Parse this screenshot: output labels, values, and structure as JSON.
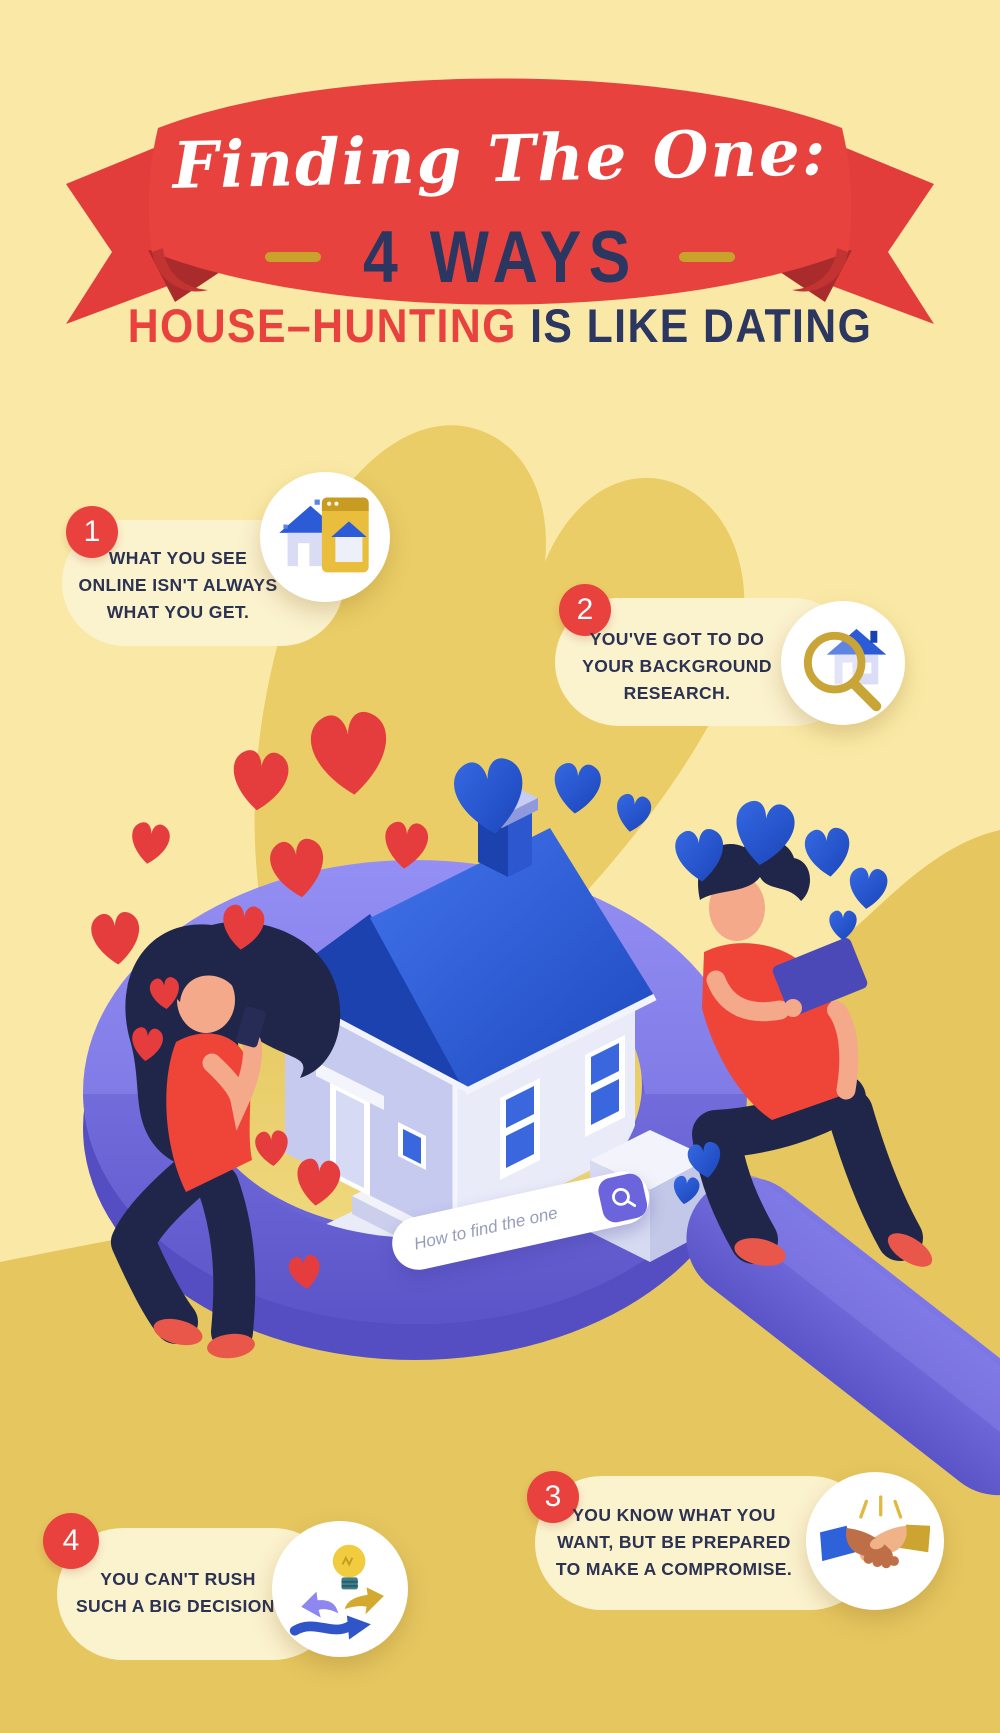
{
  "title": {
    "ribbon_text": "Finding The One:",
    "ways_label": "4 WAYS",
    "subtitle_red": "HOUSE–HUNTING",
    "subtitle_navy": "IS LIKE DATING"
  },
  "points": [
    {
      "number": "1",
      "lines": [
        "WHAT YOU SEE",
        "ONLINE ISN'T ALWAYS",
        "WHAT YOU GET."
      ],
      "icon": "house-browser"
    },
    {
      "number": "2",
      "lines": [
        "YOU'VE GOT TO DO",
        "YOUR BACKGROUND",
        "RESEARCH."
      ],
      "icon": "house-magnifier"
    },
    {
      "number": "3",
      "lines": [
        "YOU KNOW WHAT YOU",
        "WANT, BUT BE PREPARED",
        "TO MAKE A COMPROMISE."
      ],
      "icon": "handshake"
    },
    {
      "number": "4",
      "lines": [
        "YOU CAN'T RUSH",
        "SUCH A BIG DECISION."
      ],
      "icon": "lightbulb-arrows"
    }
  ],
  "search": {
    "query": "How to find the one",
    "icon": "magnifier"
  },
  "colors": {
    "red": "#E8413E",
    "navy": "#2B3252",
    "gold": "#E5C65F",
    "pale_yellow": "#FAE9A6",
    "cream": "#FBF2CE",
    "purple": "#6B64DC",
    "roof_blue": "#2B5BD7",
    "white": "#FFFFFF"
  }
}
